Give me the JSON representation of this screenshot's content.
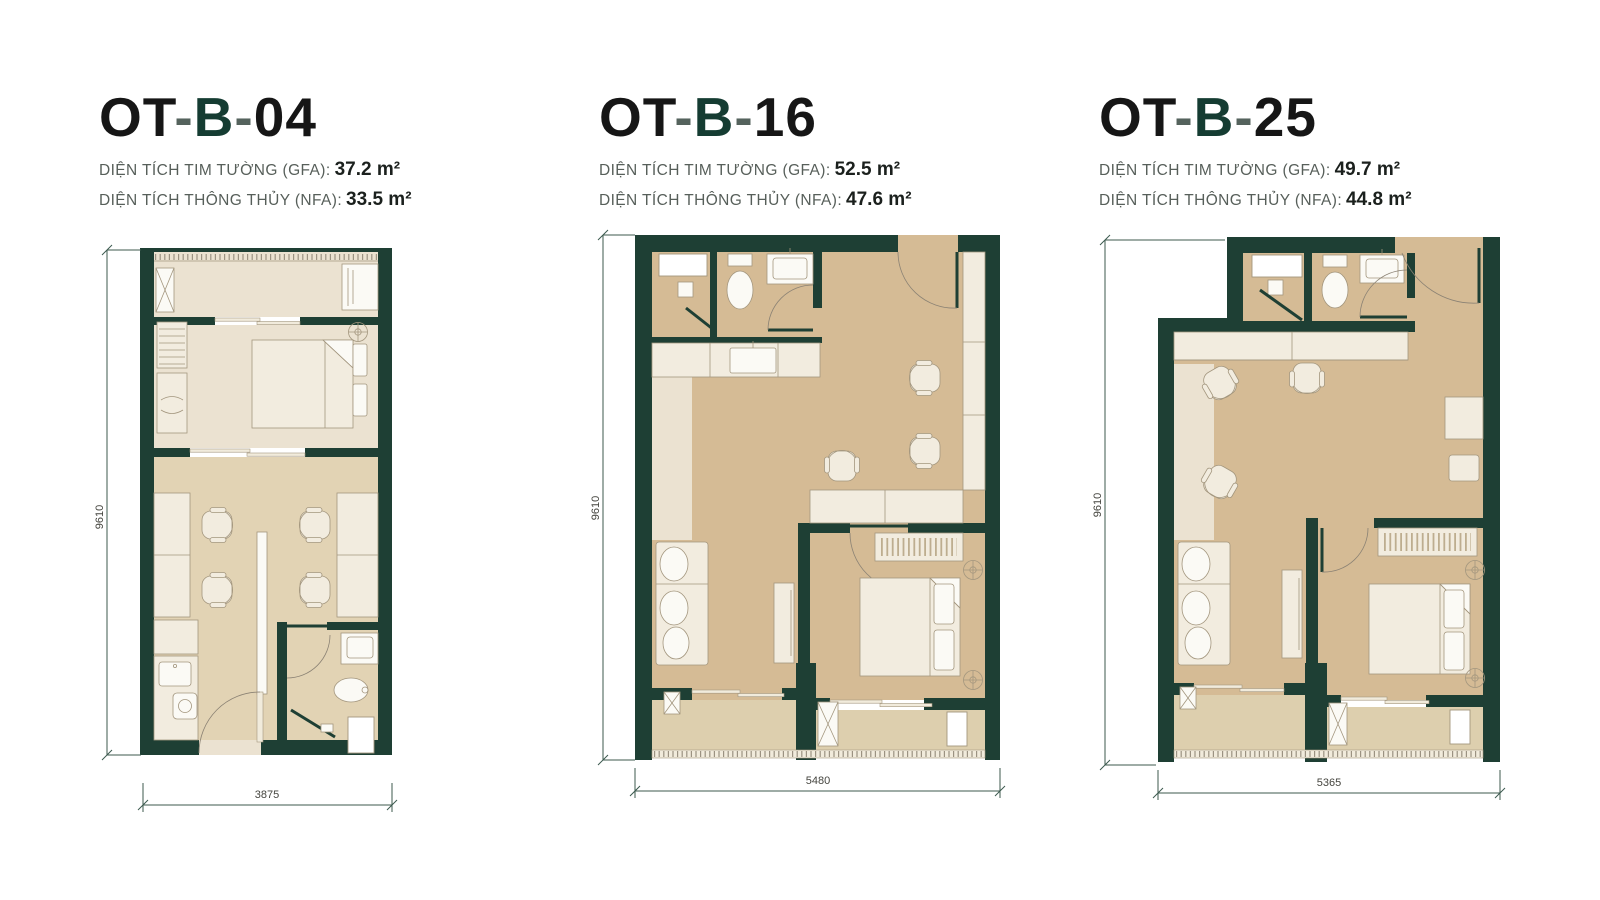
{
  "colors": {
    "wall": "#1e3f34",
    "accent": "#153c32",
    "floor_tan": "#d5bb95",
    "floor_tan_light": "#e2d3b4",
    "floor_light": "#ebe2d1",
    "floor_balcony": "#ddcfae",
    "furniture": "#f2ecdf",
    "furniture_white": "#fbfaf5",
    "outline": "#a3967e",
    "dim": "#3c5a4e",
    "title_text": "#161616",
    "dash_text": "#55635d",
    "label_text": "#575f5a",
    "value_text": "#1b201d"
  },
  "units": [
    {
      "code": {
        "t1": "OT",
        "dash": "-",
        "accent": "B",
        "t2": "04"
      },
      "gfa_label": "DIỆN TÍCH TIM TƯỜNG (GFA):",
      "gfa_value": "37.2 m²",
      "nfa_label": "DIỆN TÍCH THÔNG THỦY (NFA):",
      "nfa_value": "33.5 m²",
      "dim_height": "9610",
      "dim_width": "3875"
    },
    {
      "code": {
        "t1": "OT",
        "dash": "-",
        "accent": "B",
        "t2": "16"
      },
      "gfa_label": "DIỆN TÍCH TIM TƯỜNG (GFA):",
      "gfa_value": "52.5 m²",
      "nfa_label": "DIỆN TÍCH THÔNG THỦY (NFA):",
      "nfa_value": "47.6 m²",
      "dim_height": "9610",
      "dim_width": "5480"
    },
    {
      "code": {
        "t1": "OT",
        "dash": "-",
        "accent": "B",
        "t2": "25"
      },
      "gfa_label": "DIỆN TÍCH TIM TƯỜNG (GFA):",
      "gfa_value": "49.7 m²",
      "nfa_label": "DIỆN TÍCH THÔNG THỦY (NFA):",
      "nfa_value": "44.8 m²",
      "dim_height": "9610",
      "dim_width": "5365"
    }
  ]
}
